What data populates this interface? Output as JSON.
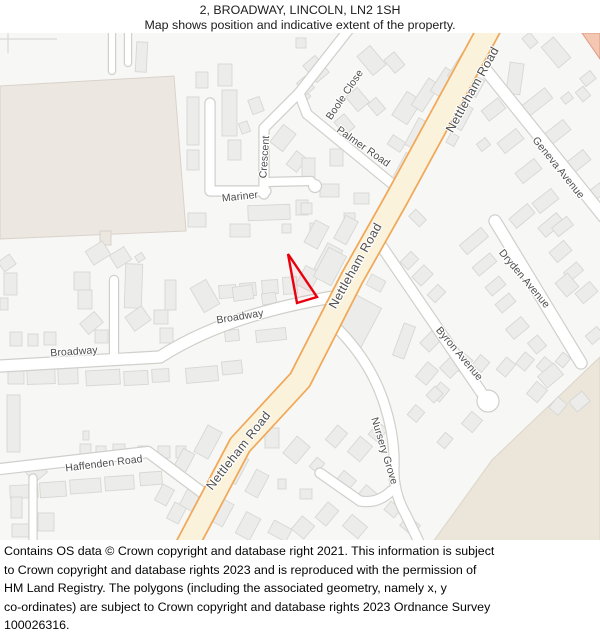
{
  "header": {
    "title": "2, BROADWAY, LINCOLN, LN2 1SH",
    "subtitle": "Map shows position and indicative extent of the property."
  },
  "footer": {
    "lines": [
      "Contains OS data © Crown copyright and database right 2021. This information is subject",
      "to Crown copyright and database rights 2023 and is reproduced with the permission of",
      "HM Land Registry. The polygons (including the associated geometry, namely x, y",
      "co-ordinates) are subject to Crown copyright and database rights 2023 Ordnance Survey",
      "100026316."
    ]
  },
  "map": {
    "colors": {
      "bg": "#F7F7F5",
      "building_fill": "#ECECEA",
      "building_stroke": "#D7D7D4",
      "road_fill": "#FFFFFF",
      "road_casing": "#CFCFCB",
      "main_road_fill": "#FBF2DB",
      "main_road_casing": "#F0A85A",
      "label": "#4D4D4D",
      "label_halo": "#FFFFFF",
      "property_outline": "#E8000D",
      "tan_area": "#EDE7E1",
      "tan_stroke": "#D9D2CB",
      "beige_area": "#EBE5DA",
      "beige_stroke": "#DCD5C9",
      "salmon_area": "#F3C7B1",
      "salmon_stroke": "#E09B83",
      "fence": "#D9D9D6"
    },
    "areas": [
      {
        "name": "playing-field",
        "points": "0,86 174,76 186,231 0,239",
        "fill": "tan_area",
        "stroke": "tan_stroke"
      },
      {
        "name": "tan-stub",
        "points": "100,231 111,231 111,245 100,245",
        "fill": "tan_area",
        "stroke": "tan_stroke"
      },
      {
        "name": "open-land-southeast",
        "points": "600,357 492,460 430,546 600,546",
        "fill": "beige_area",
        "stroke": "beige_stroke"
      },
      {
        "name": "area-northeast",
        "points": "582,33 600,33 600,59",
        "fill": "salmon_area",
        "stroke": "salmon_stroke"
      }
    ],
    "fences": [
      "M0,39 L57,39",
      "M8,33 L8,53"
    ],
    "property": {
      "label": "2 Broadway property extent",
      "points": "288,254 317,297 297,303",
      "stroke_width": 2.4
    },
    "main_road": {
      "name": "Nettleham Road",
      "path": "M495,18 L396,200 L352,278 L300,380 L240,445 L183,553",
      "width": 21,
      "casing_width": 24.5
    },
    "minor_roads": [
      {
        "name": "boole-close",
        "path": "M350,28 L299,93 L307,114",
        "w": 9
      },
      {
        "name": "crescent-diagonal",
        "path": "M264,194 L264,128 L299,93",
        "w": 9
      },
      {
        "name": "mariner",
        "path": "M210,103 L210,191 L266,191",
        "w": 9
      },
      {
        "name": "crescent-stub",
        "path": "M266,182 L311,181",
        "w": 8
      },
      {
        "name": "palmer-road",
        "path": "M307,114 L396,187",
        "w": 9
      },
      {
        "name": "broadway",
        "path": "M0,366 L160,357 Q225,315 333,297",
        "w": 11
      },
      {
        "name": "haffenden-road",
        "path": "M0,469 L148,452 L203,493",
        "w": 10
      },
      {
        "name": "south-west-stub",
        "path": "M33,478 L33,547",
        "w": 7
      },
      {
        "name": "driveway",
        "path": "M114,357 L114,280",
        "w": 8
      },
      {
        "name": "north-stub-1",
        "path": "M112,30 L112,71",
        "w": 6
      },
      {
        "name": "north-stub-2",
        "path": "M128,30 L128,63",
        "w": 6
      },
      {
        "name": "geneva-avenue",
        "path": "M481,64 L604,217",
        "w": 11
      },
      {
        "name": "dryden-avenue",
        "path": "M495,221 L581,363",
        "w": 11
      },
      {
        "name": "byron-avenue",
        "path": "M380,244 L481,392",
        "w": 10
      },
      {
        "name": "nursery-grove",
        "path": "M339,330 Q370,362 383,400 Q395,435 394,467 Q393,492 406,515 L420,544",
        "w": 9
      },
      {
        "name": "nursery-grove-arm",
        "path": "M391,491 Q378,504 360,501 L320,473",
        "w": 9
      }
    ],
    "bulbs": [
      {
        "name": "crescent-bulb",
        "cx": 315,
        "cy": 186,
        "r": 6.5
      },
      {
        "name": "byron-bulb",
        "cx": 488,
        "cy": 401,
        "r": 11
      }
    ],
    "street_labels": [
      {
        "text": "Boole Close",
        "x": 345,
        "y": 95,
        "rot": -56,
        "size": 10.5
      },
      {
        "text": "Palmer Road",
        "x": 363,
        "y": 147,
        "rot": 35,
        "size": 10.5
      },
      {
        "text": "Nettleham Road",
        "x": 473,
        "y": 90,
        "rot": -61,
        "size": 12.5
      },
      {
        "text": "Nettleham Road",
        "x": 356,
        "y": 266,
        "rot": -61,
        "size": 12.5
      },
      {
        "text": "Nettleham Road",
        "x": 239,
        "y": 451,
        "rot": -52,
        "size": 12.5
      },
      {
        "text": "Geneva Avenue",
        "x": 558,
        "y": 168,
        "rot": 51,
        "size": 10.5
      },
      {
        "text": "Dryden Avenue",
        "x": 524,
        "y": 279,
        "rot": 50,
        "size": 10.5
      },
      {
        "text": "Byron Avenue",
        "x": 459,
        "y": 354,
        "rot": 50,
        "size": 10.5
      },
      {
        "text": "Nursery Grove",
        "x": 384,
        "y": 451,
        "rot": 73,
        "size": 10.5
      },
      {
        "text": "Mariner",
        "x": 240,
        "y": 197,
        "rot": -6,
        "size": 10.5
      },
      {
        "text": "Crescent",
        "x": 265,
        "y": 157,
        "rot": -86,
        "size": 10.5
      },
      {
        "text": "Broadway",
        "x": 74,
        "y": 352,
        "rot": -4,
        "size": 10.5
      },
      {
        "text": "Broadway",
        "x": 240,
        "y": 317,
        "rot": -9,
        "size": 10.5
      },
      {
        "text": "Haffenden Road",
        "x": 104,
        "y": 464,
        "rot": -7,
        "size": 10.5
      }
    ],
    "buildings": [
      [
        136,
        42,
        11,
        30,
        3
      ],
      [
        296,
        38,
        10,
        10,
        0
      ],
      [
        187,
        97,
        12,
        48,
        0
      ],
      [
        187,
        150,
        12,
        20,
        0
      ],
      [
        196,
        72,
        12,
        16,
        0
      ],
      [
        218,
        64,
        14,
        22,
        0
      ],
      [
        222,
        90,
        15,
        46,
        0
      ],
      [
        228,
        140,
        13,
        20,
        0
      ],
      [
        250,
        98,
        12,
        15,
        -20
      ],
      [
        240,
        122,
        9,
        11,
        -20
      ],
      [
        275,
        127,
        16,
        22,
        38
      ],
      [
        290,
        153,
        13,
        17,
        38
      ],
      [
        296,
        90,
        12,
        13,
        45
      ],
      [
        248,
        205,
        42,
        15,
        -2
      ],
      [
        296,
        200,
        12,
        15,
        0
      ],
      [
        230,
        224,
        20,
        13,
        0
      ],
      [
        188,
        213,
        18,
        14,
        0
      ],
      [
        282,
        224,
        9,
        9,
        0
      ],
      [
        310,
        223,
        8,
        8,
        0
      ],
      [
        308,
        58,
        16,
        22,
        -40
      ],
      [
        300,
        78,
        11,
        15,
        -40
      ],
      [
        363,
        48,
        17,
        25,
        -40
      ],
      [
        388,
        54,
        13,
        17,
        -40
      ],
      [
        350,
        90,
        15,
        19,
        -40
      ],
      [
        371,
        99,
        11,
        15,
        -40
      ],
      [
        338,
        116,
        13,
        17,
        -40
      ],
      [
        398,
        94,
        18,
        28,
        33
      ],
      [
        419,
        79,
        13,
        32,
        33
      ],
      [
        437,
        68,
        11,
        28,
        33
      ],
      [
        454,
        54,
        11,
        27,
        33
      ],
      [
        469,
        44,
        10,
        22,
        33
      ],
      [
        389,
        138,
        15,
        11,
        33
      ],
      [
        330,
        149,
        13,
        17,
        0
      ],
      [
        302,
        158,
        13,
        19,
        0
      ],
      [
        320,
        184,
        19,
        13,
        0
      ],
      [
        354,
        193,
        15,
        11,
        0
      ],
      [
        301,
        203,
        11,
        11,
        0
      ],
      [
        344,
        213,
        11,
        9,
        0
      ],
      [
        411,
        119,
        13,
        30,
        28
      ],
      [
        399,
        154,
        13,
        27,
        28
      ],
      [
        386,
        183,
        12,
        24,
        28
      ],
      [
        339,
        217,
        14,
        26,
        28
      ],
      [
        309,
        222,
        15,
        25,
        28
      ],
      [
        320,
        245,
        17,
        29,
        28
      ],
      [
        219,
        285,
        17,
        13,
        -4
      ],
      [
        240,
        283,
        16,
        13,
        -4
      ],
      [
        262,
        280,
        16,
        14,
        -4
      ],
      [
        283,
        277,
        14,
        17,
        -4
      ],
      [
        300,
        268,
        16,
        21,
        28
      ],
      [
        320,
        250,
        20,
        33,
        28
      ],
      [
        225,
        330,
        14,
        11,
        -6
      ],
      [
        256,
        329,
        30,
        12,
        -6
      ],
      [
        344,
        299,
        29,
        44,
        28
      ],
      [
        368,
        277,
        16,
        12,
        28
      ],
      [
        0,
        257,
        14,
        12,
        -35
      ],
      [
        4,
        273,
        13,
        22,
        0
      ],
      [
        0,
        298,
        8,
        12,
        0
      ],
      [
        88,
        245,
        20,
        16,
        -32
      ],
      [
        112,
        250,
        17,
        15,
        -32
      ],
      [
        136,
        254,
        8,
        7,
        -32
      ],
      [
        74,
        272,
        16,
        18,
        0
      ],
      [
        78,
        290,
        14,
        19,
        0
      ],
      [
        82,
        316,
        19,
        14,
        -40
      ],
      [
        125,
        264,
        17,
        44,
        2
      ],
      [
        128,
        310,
        20,
        17,
        -35
      ],
      [
        154,
        310,
        14,
        14,
        0
      ],
      [
        10,
        332,
        12,
        14,
        0
      ],
      [
        28,
        334,
        10,
        12,
        0
      ],
      [
        44,
        332,
        12,
        13,
        0
      ],
      [
        95,
        330,
        13,
        13,
        0
      ],
      [
        160,
        328,
        13,
        15,
        0
      ],
      [
        196,
        282,
        18,
        28,
        -30
      ],
      [
        233,
        286,
        20,
        14,
        -8
      ],
      [
        262,
        293,
        14,
        11,
        -8
      ],
      [
        165,
        280,
        11,
        30,
        0
      ],
      [
        8,
        368,
        16,
        16,
        0
      ],
      [
        27,
        366,
        28,
        18,
        -2
      ],
      [
        58,
        368,
        20,
        16,
        -2
      ],
      [
        86,
        370,
        34,
        15,
        -3
      ],
      [
        124,
        371,
        24,
        14,
        -3
      ],
      [
        152,
        369,
        17,
        13,
        -3
      ],
      [
        186,
        367,
        32,
        15,
        -5
      ],
      [
        222,
        361,
        20,
        13,
        -6
      ],
      [
        7,
        395,
        13,
        57,
        0
      ],
      [
        80,
        444,
        11,
        10,
        0
      ],
      [
        96,
        446,
        10,
        10,
        0
      ],
      [
        113,
        444,
        12,
        12,
        0
      ],
      [
        138,
        446,
        10,
        10,
        0
      ],
      [
        158,
        446,
        12,
        12,
        0
      ],
      [
        176,
        446,
        10,
        12,
        0
      ],
      [
        83,
        431,
        6,
        9,
        0
      ],
      [
        28,
        465,
        17,
        14,
        -40
      ],
      [
        10,
        485,
        28,
        13,
        -3
      ],
      [
        11,
        497,
        11,
        21,
        0
      ],
      [
        40,
        482,
        26,
        15,
        -4
      ],
      [
        70,
        479,
        31,
        14,
        -4
      ],
      [
        105,
        476,
        29,
        14,
        -4
      ],
      [
        140,
        472,
        22,
        13,
        -4
      ],
      [
        38,
        513,
        16,
        18,
        0
      ],
      [
        12,
        524,
        17,
        13,
        0
      ],
      [
        158,
        486,
        13,
        18,
        28
      ],
      [
        170,
        504,
        13,
        18,
        28
      ],
      [
        183,
        490,
        14,
        19,
        28
      ],
      [
        200,
        427,
        16,
        30,
        28
      ],
      [
        177,
        450,
        13,
        24,
        28
      ],
      [
        230,
        455,
        13,
        28,
        28
      ],
      [
        250,
        471,
        14,
        25,
        28
      ],
      [
        215,
        500,
        14,
        25,
        28
      ],
      [
        240,
        514,
        16,
        24,
        28
      ],
      [
        270,
        524,
        20,
        14,
        28
      ],
      [
        265,
        428,
        14,
        20,
        0
      ],
      [
        288,
        439,
        17,
        22,
        40
      ],
      [
        312,
        459,
        10,
        12,
        40
      ],
      [
        330,
        427,
        13,
        19,
        40
      ],
      [
        352,
        439,
        16,
        20,
        40
      ],
      [
        372,
        424,
        12,
        16,
        40
      ],
      [
        338,
        474,
        16,
        13,
        40
      ],
      [
        360,
        489,
        18,
        13,
        40
      ],
      [
        300,
        489,
        12,
        10,
        0
      ],
      [
        278,
        479,
        8,
        10,
        0
      ],
      [
        320,
        504,
        14,
        20,
        40
      ],
      [
        295,
        519,
        16,
        17,
        40
      ],
      [
        345,
        519,
        20,
        15,
        40
      ],
      [
        386,
        504,
        13,
        11,
        40
      ],
      [
        402,
        519,
        16,
        13,
        40
      ],
      [
        420,
        364,
        14,
        19,
        40
      ],
      [
        434,
        384,
        12,
        16,
        40
      ],
      [
        455,
        354,
        14,
        17,
        40
      ],
      [
        465,
        414,
        14,
        16,
        40
      ],
      [
        440,
        434,
        10,
        13,
        40
      ],
      [
        410,
        407,
        12,
        13,
        40
      ],
      [
        475,
        357,
        12,
        13,
        40
      ],
      [
        500,
        359,
        12,
        16,
        40
      ],
      [
        519,
        354,
        12,
        15,
        40
      ],
      [
        539,
        359,
        12,
        13,
        40
      ],
      [
        558,
        354,
        10,
        12,
        40
      ],
      [
        530,
        384,
        14,
        16,
        40
      ],
      [
        552,
        399,
        12,
        14,
        40
      ],
      [
        410,
        213,
        15,
        10,
        45
      ],
      [
        404,
        253,
        11,
        15,
        45
      ],
      [
        416,
        267,
        13,
        17,
        45
      ],
      [
        431,
        286,
        11,
        15,
        45
      ],
      [
        398,
        324,
        12,
        34,
        20
      ],
      [
        424,
        333,
        13,
        17,
        45
      ],
      [
        444,
        357,
        15,
        19,
        45
      ],
      [
        429,
        388,
        11,
        13,
        45
      ],
      [
        468,
        227,
        12,
        28,
        50
      ],
      [
        479,
        253,
        11,
        23,
        50
      ],
      [
        490,
        277,
        11,
        18,
        50
      ],
      [
        500,
        294,
        11,
        18,
        50
      ],
      [
        511,
        318,
        13,
        20,
        50
      ],
      [
        516,
        204,
        12,
        24,
        50
      ],
      [
        545,
        213,
        12,
        24,
        50
      ],
      [
        554,
        242,
        13,
        19,
        50
      ],
      [
        568,
        263,
        11,
        17,
        50
      ],
      [
        580,
        283,
        13,
        19,
        50
      ],
      [
        558,
        277,
        18,
        16,
        50
      ],
      [
        589,
        328,
        11,
        15,
        50
      ],
      [
        543,
        365,
        15,
        21,
        50
      ],
      [
        573,
        393,
        13,
        17,
        50
      ],
      [
        530,
        338,
        14,
        13,
        50
      ],
      [
        508,
        63,
        14,
        31,
        8
      ],
      [
        528,
        86,
        13,
        36,
        52
      ],
      [
        549,
        119,
        13,
        29,
        52
      ],
      [
        569,
        149,
        13,
        29,
        52
      ],
      [
        588,
        183,
        11,
        23,
        52
      ],
      [
        487,
        99,
        13,
        21,
        52
      ],
      [
        504,
        129,
        13,
        24,
        52
      ],
      [
        522,
        159,
        13,
        24,
        52
      ],
      [
        539,
        189,
        13,
        24,
        52
      ],
      [
        557,
        217,
        11,
        19,
        52
      ],
      [
        563,
        93,
        8,
        10,
        52
      ],
      [
        583,
        72,
        10,
        13,
        52
      ],
      [
        479,
        139,
        9,
        11,
        52
      ],
      [
        455,
        104,
        13,
        25,
        28
      ],
      [
        470,
        77,
        11,
        19,
        28
      ],
      [
        448,
        134,
        9,
        11,
        28
      ],
      [
        548,
        39,
        16,
        27,
        -40
      ],
      [
        578,
        88,
        10,
        12,
        -40
      ],
      [
        525,
        34,
        10,
        13,
        -40
      ]
    ]
  }
}
